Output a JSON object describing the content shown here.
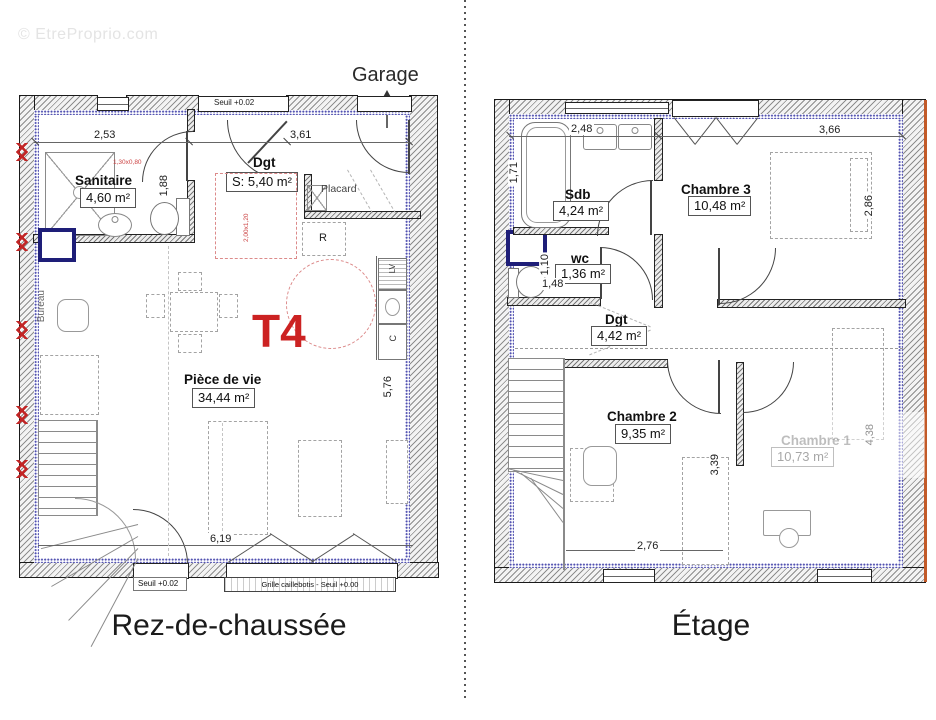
{
  "watermark": "© EtreProprio.com",
  "colors": {
    "accent_red": "#cc2222",
    "window_navy": "#1e1e78",
    "insulation_blue": "#5050b0",
    "exterior_orange": "#c25a28"
  },
  "ground": {
    "title": "Rez-de-chaussée",
    "garage_label": "Garage",
    "type_label": "T4",
    "seuil_top": "Seuil +0.02",
    "seuil_bottom": "Seuil +0.02",
    "grille_label": "Grille caillebotis - Seuil +0.00",
    "rooms": {
      "sanitaire": {
        "name": "Sanitaire",
        "area": "4,60 m²"
      },
      "dgt": {
        "name": "Dgt",
        "area": "S: 5,40 m²"
      },
      "placard": {
        "name": "Placard"
      },
      "piece_de_vie": {
        "name": "Pièce de vie",
        "area": "34,44 m²"
      },
      "bureau": {
        "name": "Bureau"
      }
    },
    "kitchen": {
      "fridge": "R",
      "dishwasher": "LV",
      "cooker": "C"
    },
    "dims": {
      "top_left": "2,53",
      "top_right": "3,61",
      "sanitaire_depth": "1,88",
      "kitchen_run": "5,76",
      "bottom_width": "6,19"
    },
    "red_notes": {
      "shower": "1,30x0,80",
      "bay": "2,00x1,20"
    }
  },
  "upper": {
    "title": "Étage",
    "rooms": {
      "sdb": {
        "name": "Sdb",
        "area": "4,24 m²"
      },
      "wc": {
        "name": "wc",
        "area": "1,36 m²"
      },
      "chambre3": {
        "name": "Chambre 3",
        "area": "10,48 m²"
      },
      "dgt": {
        "name": "Dgt",
        "area": "4,42 m²"
      },
      "chambre2": {
        "name": "Chambre 2",
        "area": "9,35 m²"
      },
      "chambre1": {
        "name": "Chambre 1",
        "area": "10,73 m²"
      }
    },
    "dims": {
      "top_left": "2,48",
      "top_right": "3,66",
      "sdb_depth": "1,71",
      "chambre3_depth": "2,86",
      "wc_depth": "1,10",
      "wc_width": "1,48",
      "chambre2_depth": "3,39",
      "chambre2_width": "2,76",
      "right_height": "4,38"
    }
  }
}
